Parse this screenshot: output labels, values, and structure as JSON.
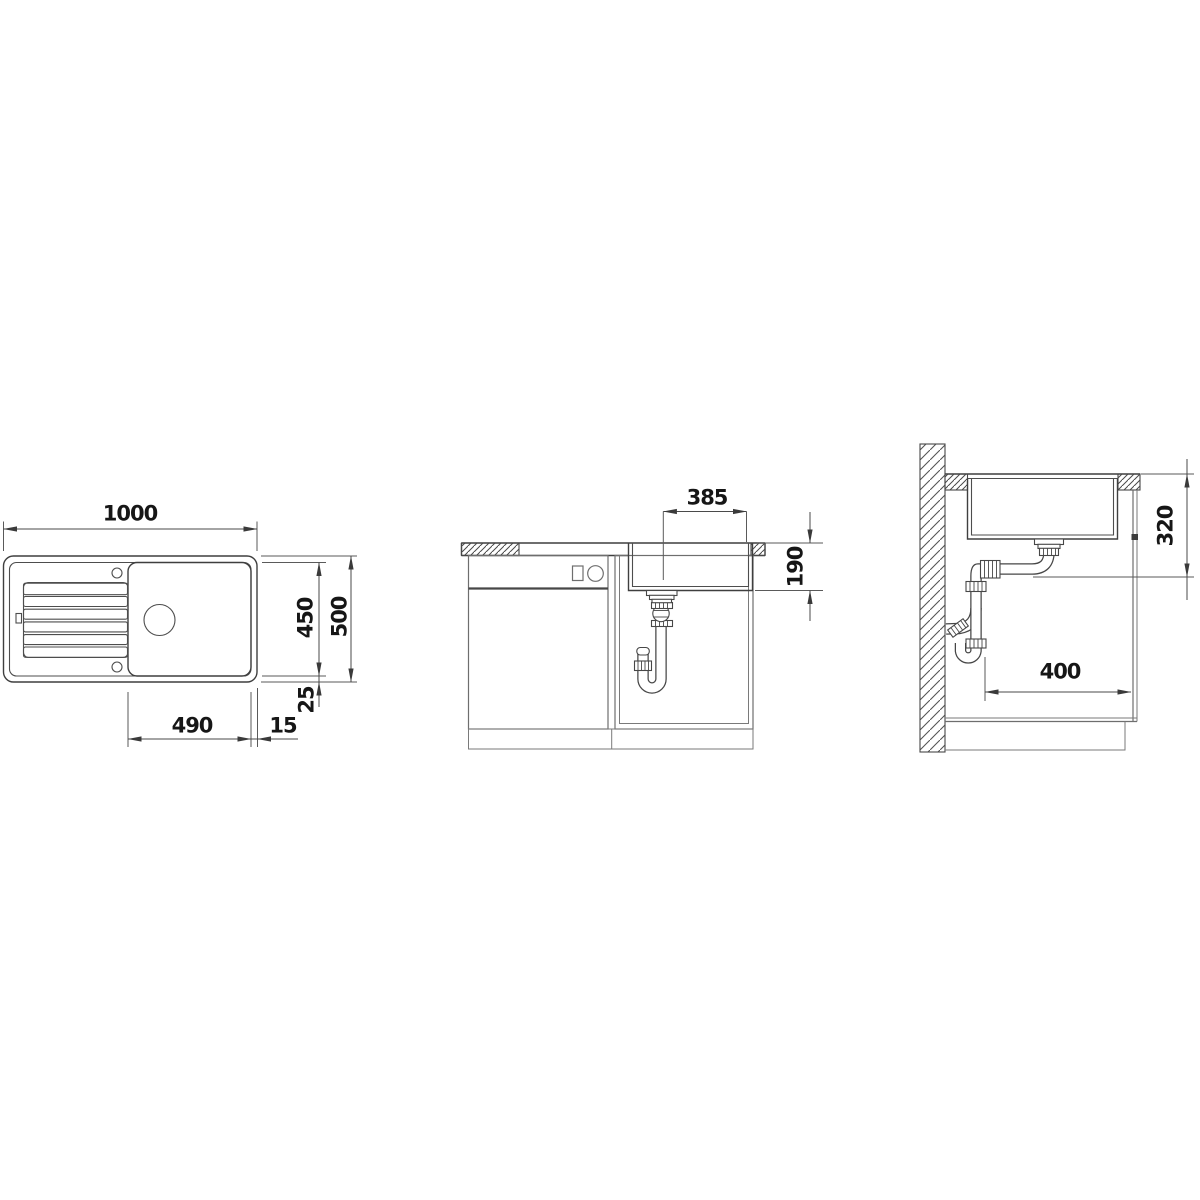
{
  "page": {
    "background": "#ffffff"
  },
  "colors": {
    "line": "#3f3f3f",
    "dimension_line": "#4a4a4a",
    "text": "#161616"
  },
  "dimensions": {
    "top_view": {
      "overall_width": "1000",
      "bowl_length": "450",
      "overall_depth": "500",
      "rim_offset": "25",
      "bowl_width": "490",
      "edge_gap": "15"
    },
    "front_view": {
      "bowl_top_width": "385",
      "bowl_depth": "190"
    },
    "side_view": {
      "clearance_height": "320",
      "wall_clearance": "400"
    }
  }
}
